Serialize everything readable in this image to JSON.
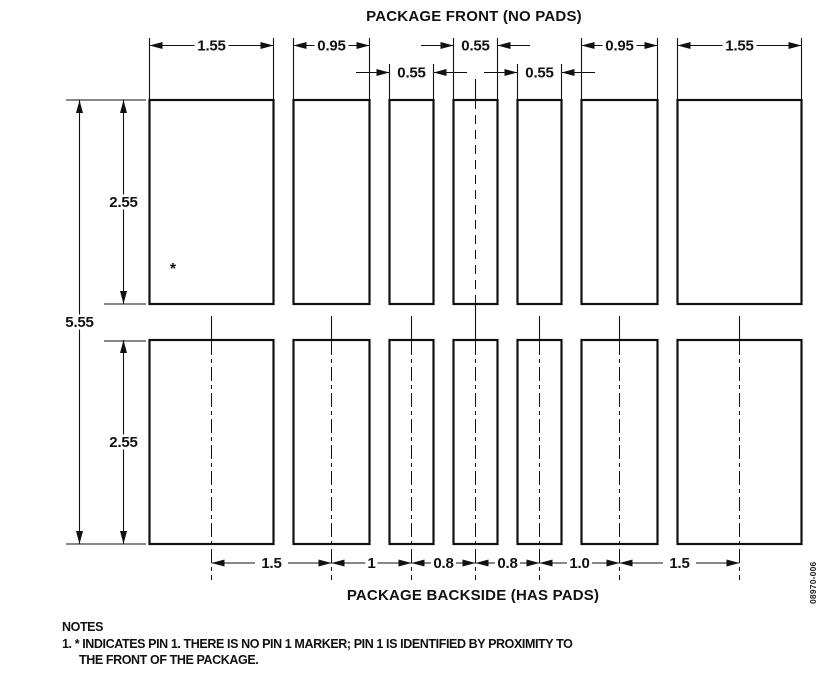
{
  "diagram": {
    "title_front": "PACKAGE FRONT (NO PADS)",
    "title_backside": "PACKAGE BACKSIDE (HAS PADS)",
    "figure_number": "08970-006",
    "pin1_marker": "*"
  },
  "dims": {
    "row1": [
      "1.55",
      "0.95",
      "0.55",
      "0.95",
      "1.55"
    ],
    "row2": [
      "0.55",
      "0.55"
    ],
    "vertical": {
      "upper": "2.55",
      "overall": "5.55",
      "lower": "2.55"
    },
    "bottom": [
      "1.5",
      "1",
      "0.8",
      "0.8",
      "1.0",
      "1.5"
    ]
  },
  "notes": {
    "heading": "NOTES",
    "line1": "1. * INDICATES PIN 1. THERE IS NO PIN 1 MARKER; PIN 1 IS IDENTIFIED BY PROXIMITY TO",
    "line2": "THE FRONT OF THE PACKAGE."
  },
  "colors": {
    "ink": "#111111",
    "background": "#ffffff"
  }
}
